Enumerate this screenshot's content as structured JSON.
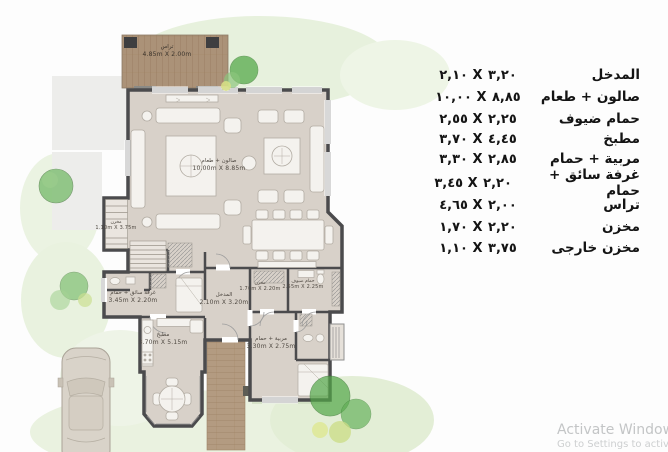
{
  "legend": {
    "rows": [
      {
        "label": "المدخل",
        "dims": "٢,١٠ X ٣,٢٠"
      },
      {
        "label": "صالون + طعام",
        "dims": "١٠,٠٠ X ٨,٨٥"
      },
      {
        "label": "حمام ضيوف",
        "dims": "٢,٥٥ X ٢,٢٥"
      },
      {
        "label": "مطبخ",
        "dims": "٣,٧٠ X ٤,٤٥"
      },
      {
        "label": "مربية + حمام",
        "dims": "٣,٣٠ X ٢,٨٥"
      },
      {
        "label": "غرفة سائق + حمام",
        "dims": "٣,٤٥ X ٢,٢٠"
      },
      {
        "label": "تراس",
        "dims": "٤,٦٥ X ٢,٠٠"
      },
      {
        "label": "مخزن",
        "dims": "١,٧٠ X ٢,٢٠"
      },
      {
        "label": "مخزن خارجى",
        "dims": "١,١٠ X ٣,٧٥"
      }
    ]
  },
  "plan": {
    "rooms": {
      "terrace": {
        "name": "تراس",
        "dims": "4.85m X 2.00m"
      },
      "salon": {
        "name": "صالون + طعام",
        "dims": "10.00m X 8.85m"
      },
      "kitchen": {
        "name": "مطبخ",
        "dims": "3.70m X 5.15m"
      },
      "entrance": {
        "name": "المدخل",
        "dims": "2.10m X 3.20m"
      },
      "storage": {
        "name": "مخزن",
        "dims": "1.70m X 2.20m"
      },
      "guest_bath": {
        "name": "حمام ضيوف",
        "dims": "2.55m X 2.25m"
      },
      "nanny": {
        "name": "مربية + حمام",
        "dims": "3.30m X 2.75m"
      },
      "driver": {
        "name": "غرفة سائق + حمام",
        "dims": "3.45m X 2.20m"
      },
      "ext_storage": {
        "name": "مخزن",
        "dims": "1.10m X 3.75m"
      }
    }
  },
  "watermark": {
    "line1": "Activate Windows",
    "line2": "Go to Settings to activate Windows."
  },
  "colors": {
    "floor": "#d8d1c9",
    "wall": "#4b4b4d",
    "deck_wood": "#ab9278",
    "walkway_wood": "#b39b81",
    "tree_green": "#5fae54",
    "watercolor_wash": "#e7f1dd",
    "legend_text": "#141414",
    "watermark_gray": "#c3c5c6"
  }
}
